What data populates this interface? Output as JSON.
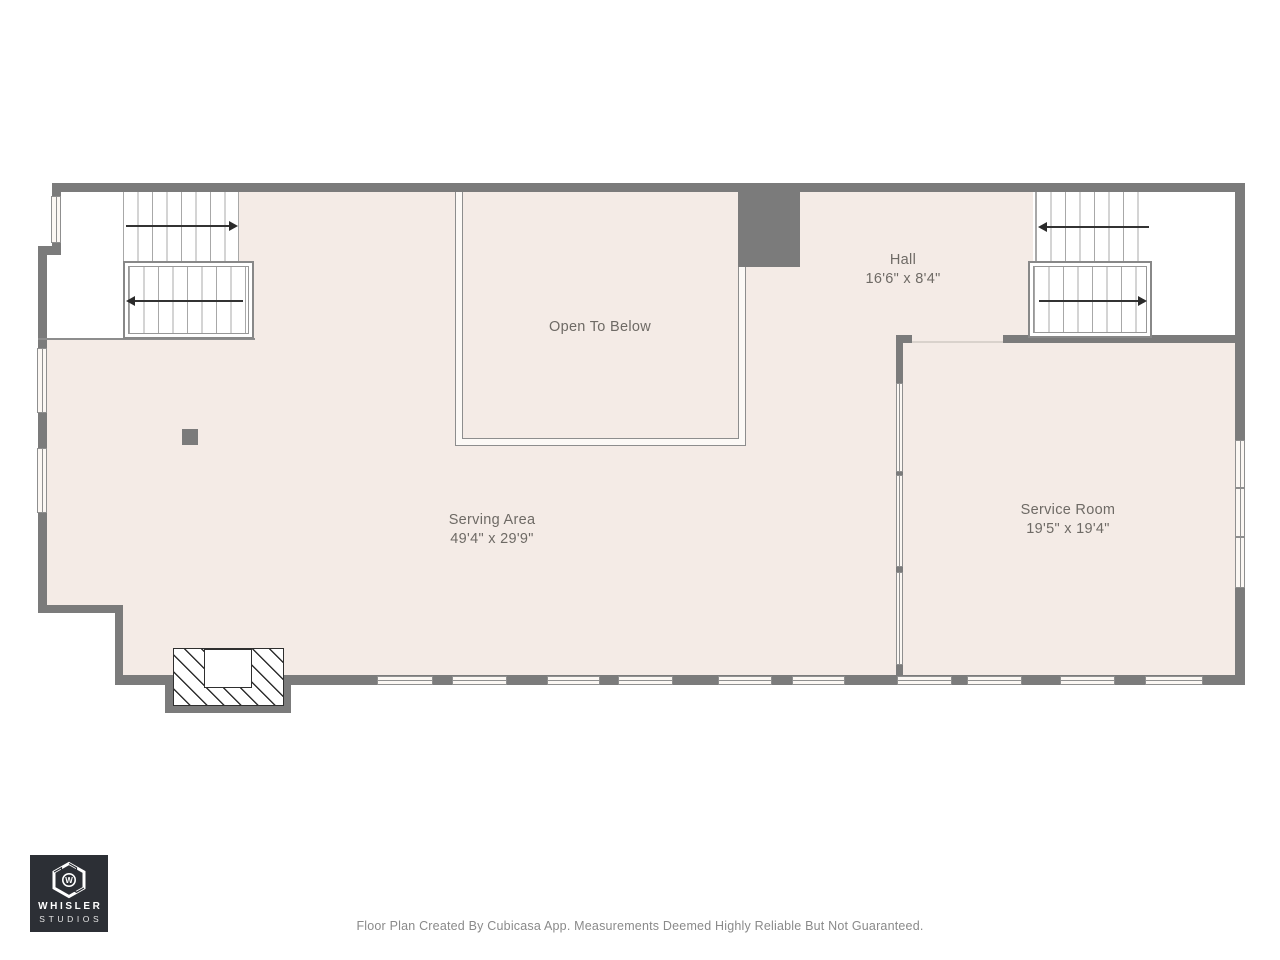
{
  "floorplan": {
    "rooms": {
      "open_to_below": {
        "label": "Open To Below"
      },
      "hall": {
        "name": "Hall",
        "dimensions": "16'6\" x 8'4\""
      },
      "serving_area": {
        "name": "Serving Area",
        "dimensions": "49'4\" x 29'9\""
      },
      "service_room": {
        "name": "Service Room",
        "dimensions": "19'5\" x 19'4\""
      }
    },
    "colors": {
      "wall": "#7b7b7b",
      "floor": "#f4ebe6",
      "detail_line": "#8d8d8d",
      "label_text": "#6e6a65"
    }
  },
  "branding": {
    "monogram": "W",
    "name_line1": "WHISLER",
    "name_line2": "STUDIOS"
  },
  "footer": {
    "disclaimer": "Floor Plan Created By Cubicasa App. Measurements Deemed Highly Reliable But Not Guaranteed."
  }
}
